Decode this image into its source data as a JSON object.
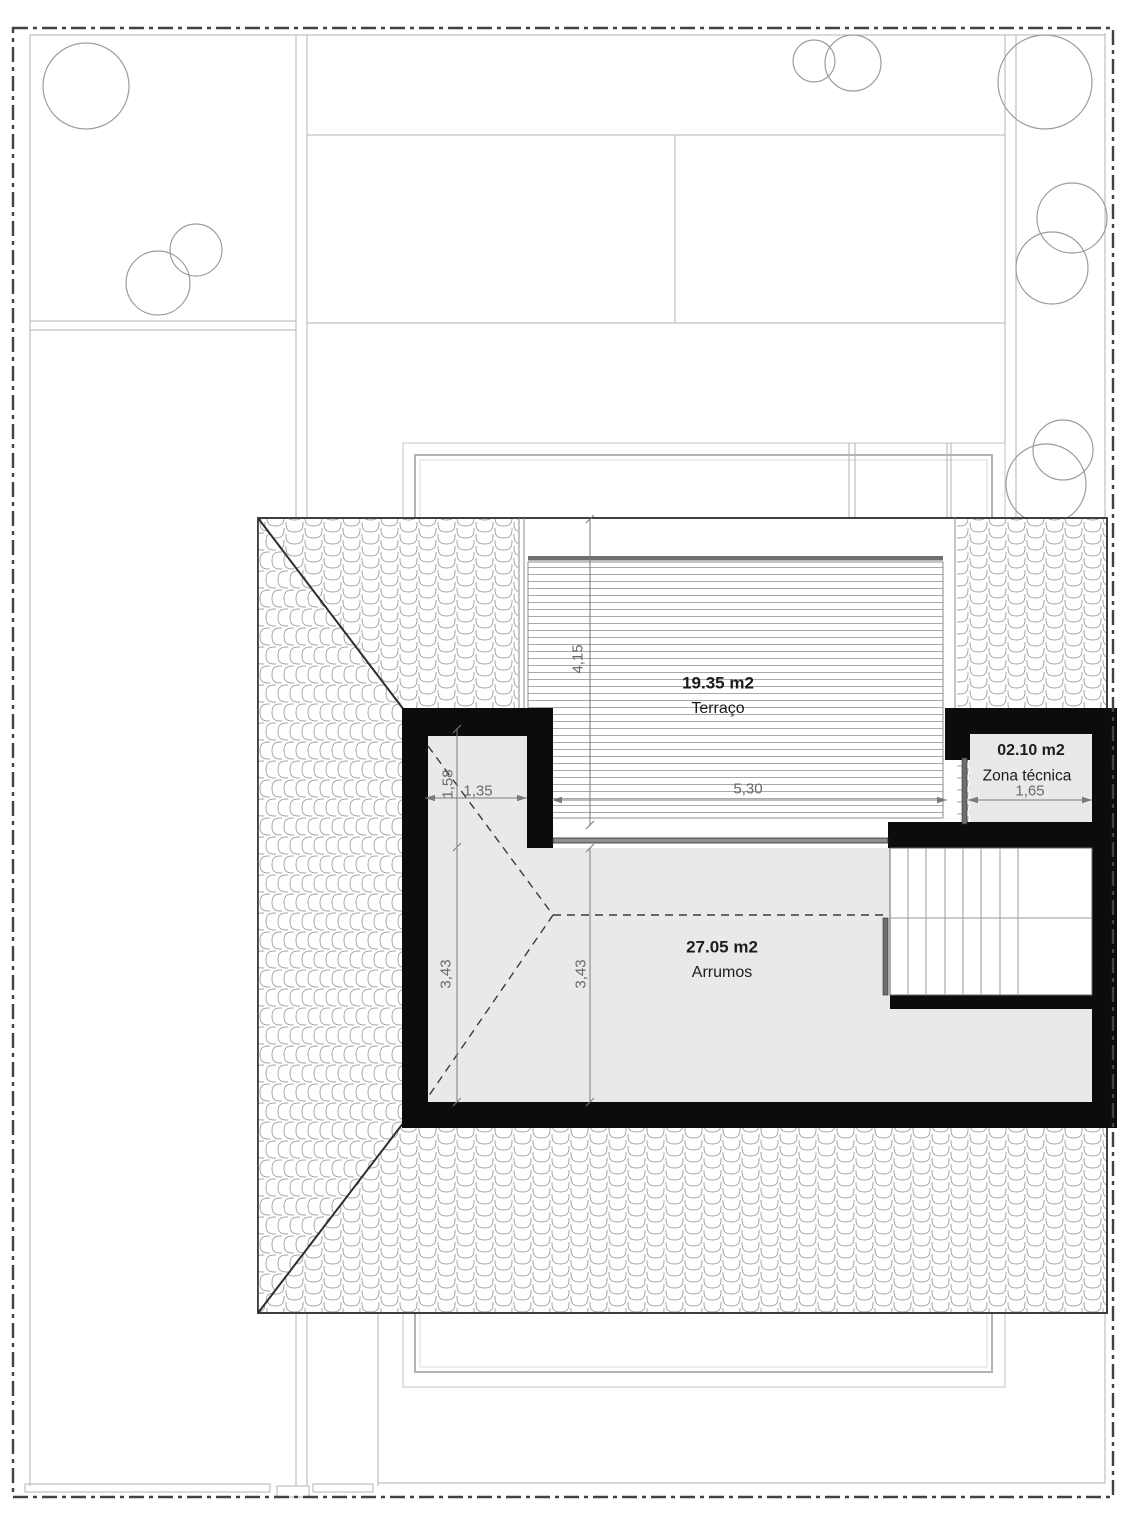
{
  "rooms": [
    {
      "area": "19.35 m2",
      "label": "Terraço"
    },
    {
      "area": "27.05 m2",
      "label": "Arrumos"
    },
    {
      "area": "02.10 m2",
      "label": "Zona técnica"
    }
  ],
  "dimensions": {
    "terrace_depth": "4,15",
    "terrace_width": "5,30",
    "closet_width": "1,35",
    "closet_depth": "1,58",
    "arrumos_depth_left": "3,43",
    "arrumos_depth_mid": "3,43",
    "zona_tecnica_width": "1,65"
  },
  "colors": {
    "wall": "#0c0c0c",
    "room_fill": "#e9e9e9",
    "dim_text": "#6a6a6a",
    "boundary": "#424242"
  }
}
